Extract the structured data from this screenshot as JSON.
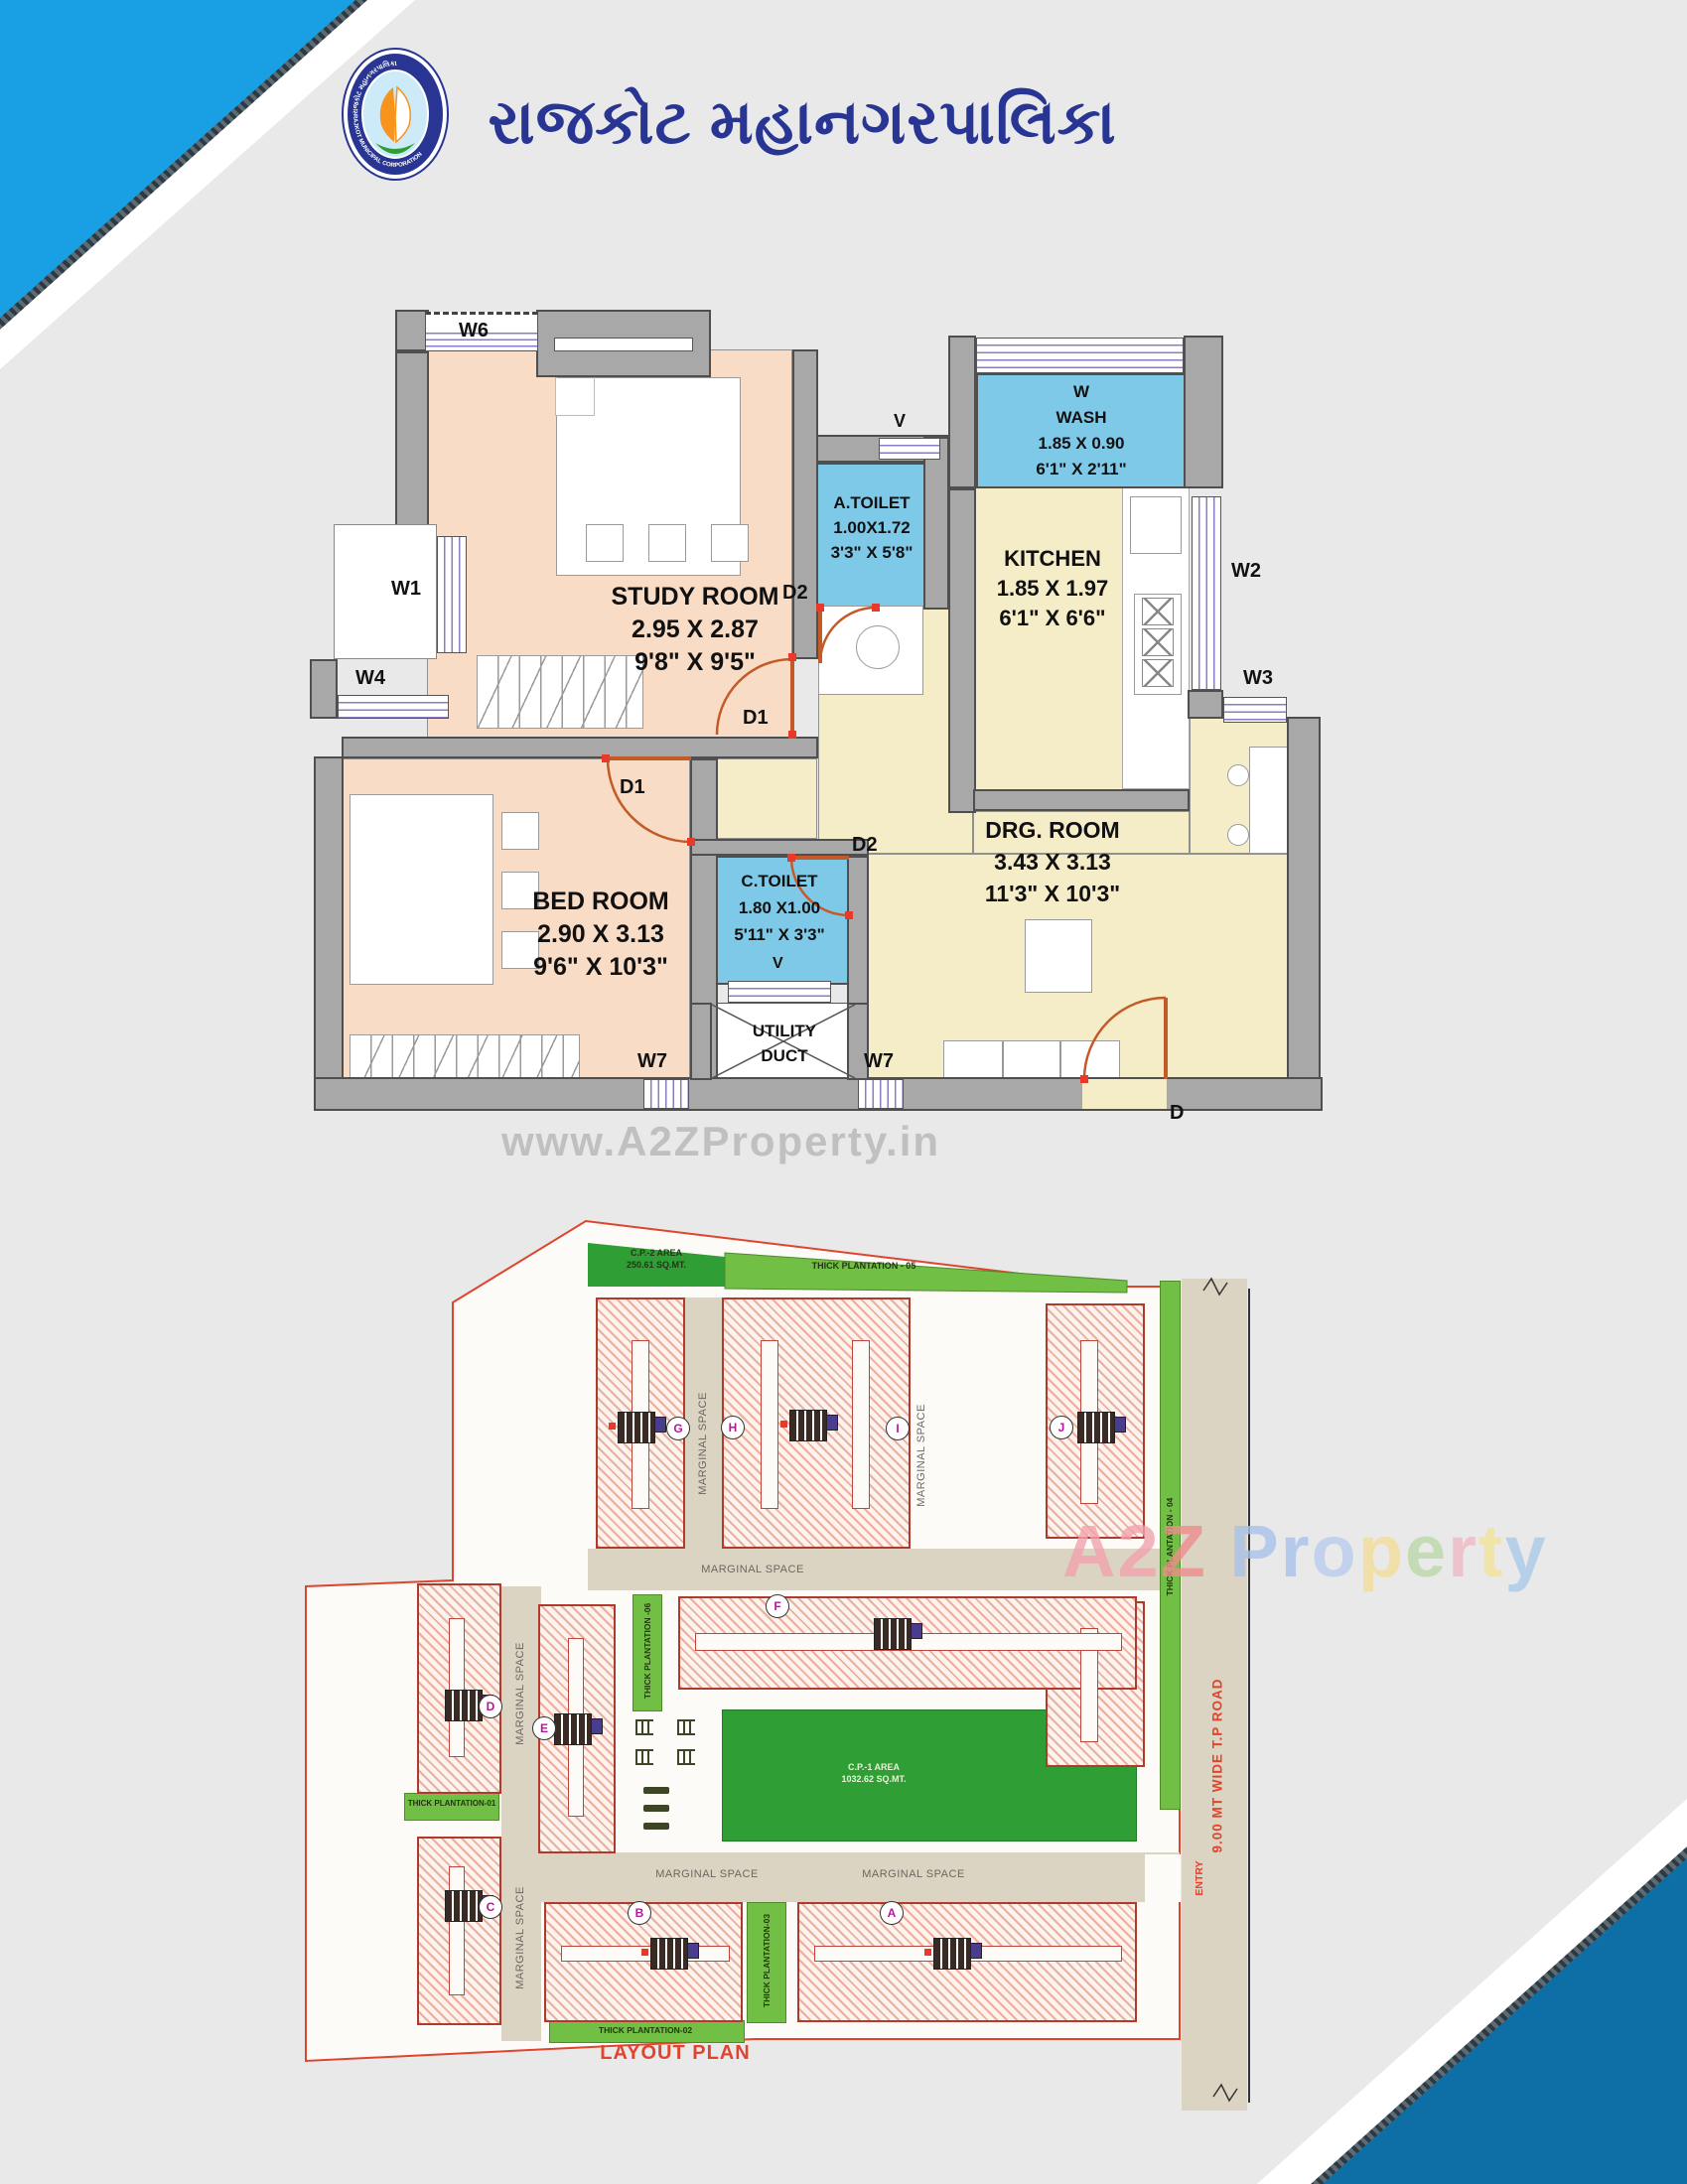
{
  "header": {
    "title": "રાજકોટ મહાનગરપાલિકા",
    "logo_ring_top": "રાજકોટ મહાનગરપાલિકા",
    "logo_ring_bottom": "RAJKOT MUNICIPAL CORPORATION"
  },
  "floor_plan": {
    "study_room": {
      "name": "STUDY ROOM",
      "m": "2.95 X 2.87",
      "ft": "9'8\" X 9'5\""
    },
    "bed_room": {
      "name": "BED ROOM",
      "m": "2.90 X 3.13",
      "ft": "9'6\" X 10'3\""
    },
    "a_toilet": {
      "name": "A.TOILET",
      "m": "1.00X1.72",
      "ft": "3'3\" X 5'8\""
    },
    "wash": {
      "tag": "W",
      "name": "WASH",
      "m": "1.85 X 0.90",
      "ft": "6'1\" X 2'11\""
    },
    "kitchen": {
      "name": "KITCHEN",
      "m": "1.85 X 1.97",
      "ft": "6'1\" X 6'6\""
    },
    "drg_room": {
      "name": "DRG. ROOM",
      "m": "3.43 X 3.13",
      "ft": "11'3\" X 10'3\""
    },
    "c_toilet": {
      "name": "C.TOILET",
      "m": "1.80 X1.00",
      "ft": "5'11\" X 3'3\""
    },
    "utility": {
      "line1": "UTILITY",
      "line2": "DUCT"
    },
    "labels": {
      "w1": "W1",
      "w2": "W2",
      "w3": "W3",
      "w4": "W4",
      "w6": "W6",
      "w7": "W7",
      "v": "V",
      "d": "D",
      "d1": "D1",
      "d2": "D2"
    }
  },
  "layout_plan": {
    "title": "LAYOUT PLAN",
    "cp2": {
      "l1": "C.P.-2 AREA",
      "l2": "250.61 SQ.MT."
    },
    "cp1": {
      "l1": "C.P.-1 AREA",
      "l2": "1032.62 SQ.MT."
    },
    "tp01": "THICK PLANTATION-01",
    "tp02": "THICK PLANTATION-02",
    "tp03": "THICK PLANTATION-03",
    "tp04": "THICK PLANTATION - 04",
    "tp05": "THICK PLANTATION - 05",
    "tp06": "THICK PLANTATION -06",
    "marginal": "MARGINAL SPACE",
    "road": "9.00 MT WIDE T.P ROAD",
    "entry": "ENTRY",
    "blocks": [
      "A",
      "B",
      "C",
      "D",
      "E",
      "F",
      "G",
      "H",
      "I",
      "J"
    ]
  },
  "watermarks": {
    "w1": "www.A2ZProperty.in",
    "w2_letters": [
      {
        "ch": "A",
        "color": "#f2a3ad"
      },
      {
        "ch": "2",
        "color": "#f2a3ad"
      },
      {
        "ch": "Z",
        "color": "#ef8d8d"
      },
      {
        "ch": " ",
        "color": "#ffffff"
      },
      {
        "ch": "P",
        "color": "#a9c3ea"
      },
      {
        "ch": "r",
        "color": "#a9c3ea"
      },
      {
        "ch": "o",
        "color": "#b9cdee"
      },
      {
        "ch": "p",
        "color": "#f3dd9a"
      },
      {
        "ch": "e",
        "color": "#bcd9a8"
      },
      {
        "ch": "r",
        "color": "#f0b9c4"
      },
      {
        "ch": "t",
        "color": "#f2e39a"
      },
      {
        "ch": "y",
        "color": "#a9cbe8"
      }
    ]
  },
  "colors": {
    "corner_blue_top": "#189fe4",
    "corner_blue_bottom": "#0d6fa5",
    "title_navy": "#283593",
    "wall_gray": "#a8a8a8",
    "room_peach": "#f8dcc6",
    "room_cream": "#f5ecc8",
    "room_blue": "#7fc9e8",
    "door_orange": "#c35a28",
    "layout_red": "#e0442e",
    "green_dark": "#2f9e35",
    "green_light": "#71bf44",
    "road_beige": "#dbd4c2"
  }
}
